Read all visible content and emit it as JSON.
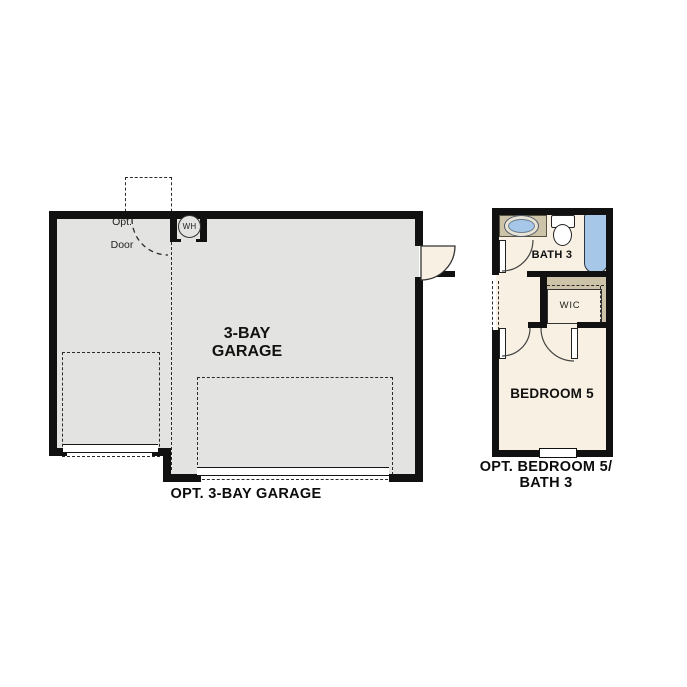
{
  "colors": {
    "wall": "#111111",
    "floor_gray": "#e3e3e1",
    "cream": "#f8f1e3",
    "tan": "#cdc3a9",
    "fixture_blue": "#a6c7e8"
  },
  "garage": {
    "water_heater_label": "WH",
    "opt_door_label_line1": "Opt.",
    "opt_door_label_line2": "Door",
    "room_label_line1": "3-BAY",
    "room_label_line2": "GARAGE",
    "caption": "OPT. 3-BAY GARAGE"
  },
  "bedroom_unit": {
    "bath_label": "BATH 3",
    "wic_label": "WIC",
    "bedroom_label": "BEDROOM 5",
    "caption_line1": "OPT. BEDROOM 5/",
    "caption_line2": "BATH 3"
  }
}
